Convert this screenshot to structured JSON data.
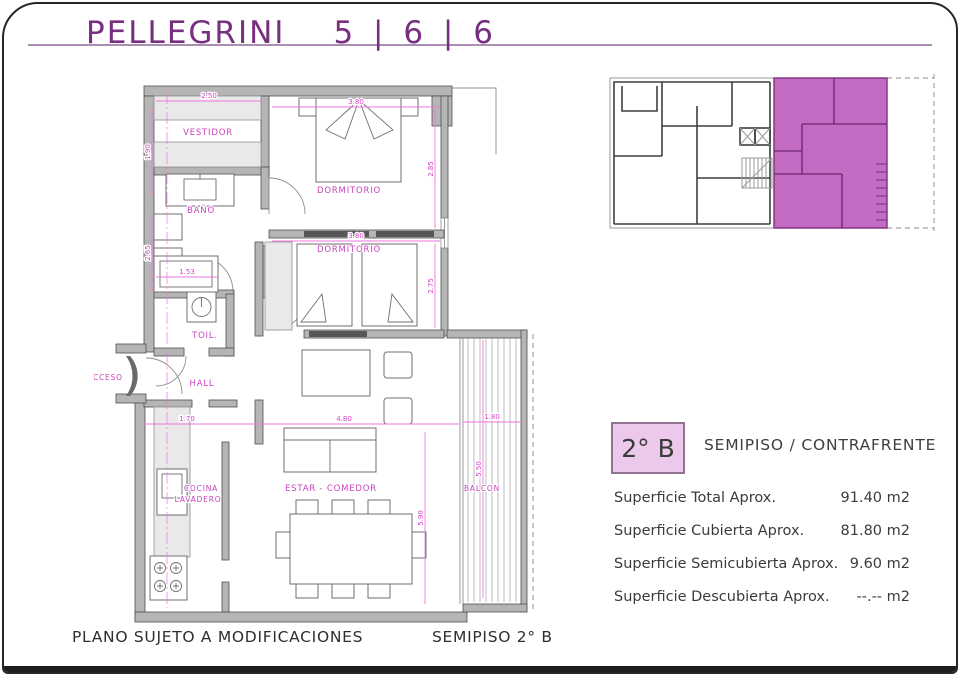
{
  "page": {
    "title": "PELLEGRINI",
    "title_numbers": "5 | 6 | 6",
    "footer_left": "PLANO SUJETO A MODIFICACIONES",
    "footer_right": "SEMIPISO 2° B"
  },
  "unit_info": {
    "badge": "2° B",
    "type_label": "SEMIPISO / CONTRAFRENTE",
    "surfaces": [
      {
        "label": "Superficie Total Aprox.",
        "value": "91.40 m2"
      },
      {
        "label": "Superficie Cubierta Aprox.",
        "value": "81.80 m2"
      },
      {
        "label": "Superficie Semicubierta Aprox.",
        "value": "9.60 m2"
      },
      {
        "label": "Superficie Descubierta Aprox.",
        "value": "--.-- m2"
      }
    ]
  },
  "floor_plan": {
    "rooms": {
      "vestidor": "VESTIDOR",
      "dormitorio_1": "DORMITORIO",
      "bano": "BAÑO",
      "dormitorio_2": "DORMITORIO",
      "toil": "TOIL.",
      "hall": "HALL",
      "acceso": "ACCESO",
      "cocina": "COCINA",
      "lavadero": "LAVADERO",
      "estar_comedor": "ESTAR - COMEDOR",
      "balcon": "BALCON"
    },
    "dimensions": {
      "vestidor_w": "2.50",
      "dorm1_w": "3.80",
      "dorm2_w": "3.80",
      "vestidor_h": "1.90",
      "bano_h": "2.65",
      "closet_w": "1.53",
      "dorm1_h": "2.85",
      "dorm2_h": "2.75",
      "cocina_w": "1.70",
      "estar_w": "4.80",
      "balcon_w": "1.80",
      "estar_h": "5.90",
      "balcon_h": "5.50"
    }
  },
  "colors": {
    "title_purple": "#76307f",
    "rule_purple": "#ab8fb3",
    "dimension_magenta": "#d445c6",
    "keyplan_highlight": "#c36ac3",
    "badge_bg": "#ecc9ea",
    "wall_gray": "#b5b5b5"
  }
}
